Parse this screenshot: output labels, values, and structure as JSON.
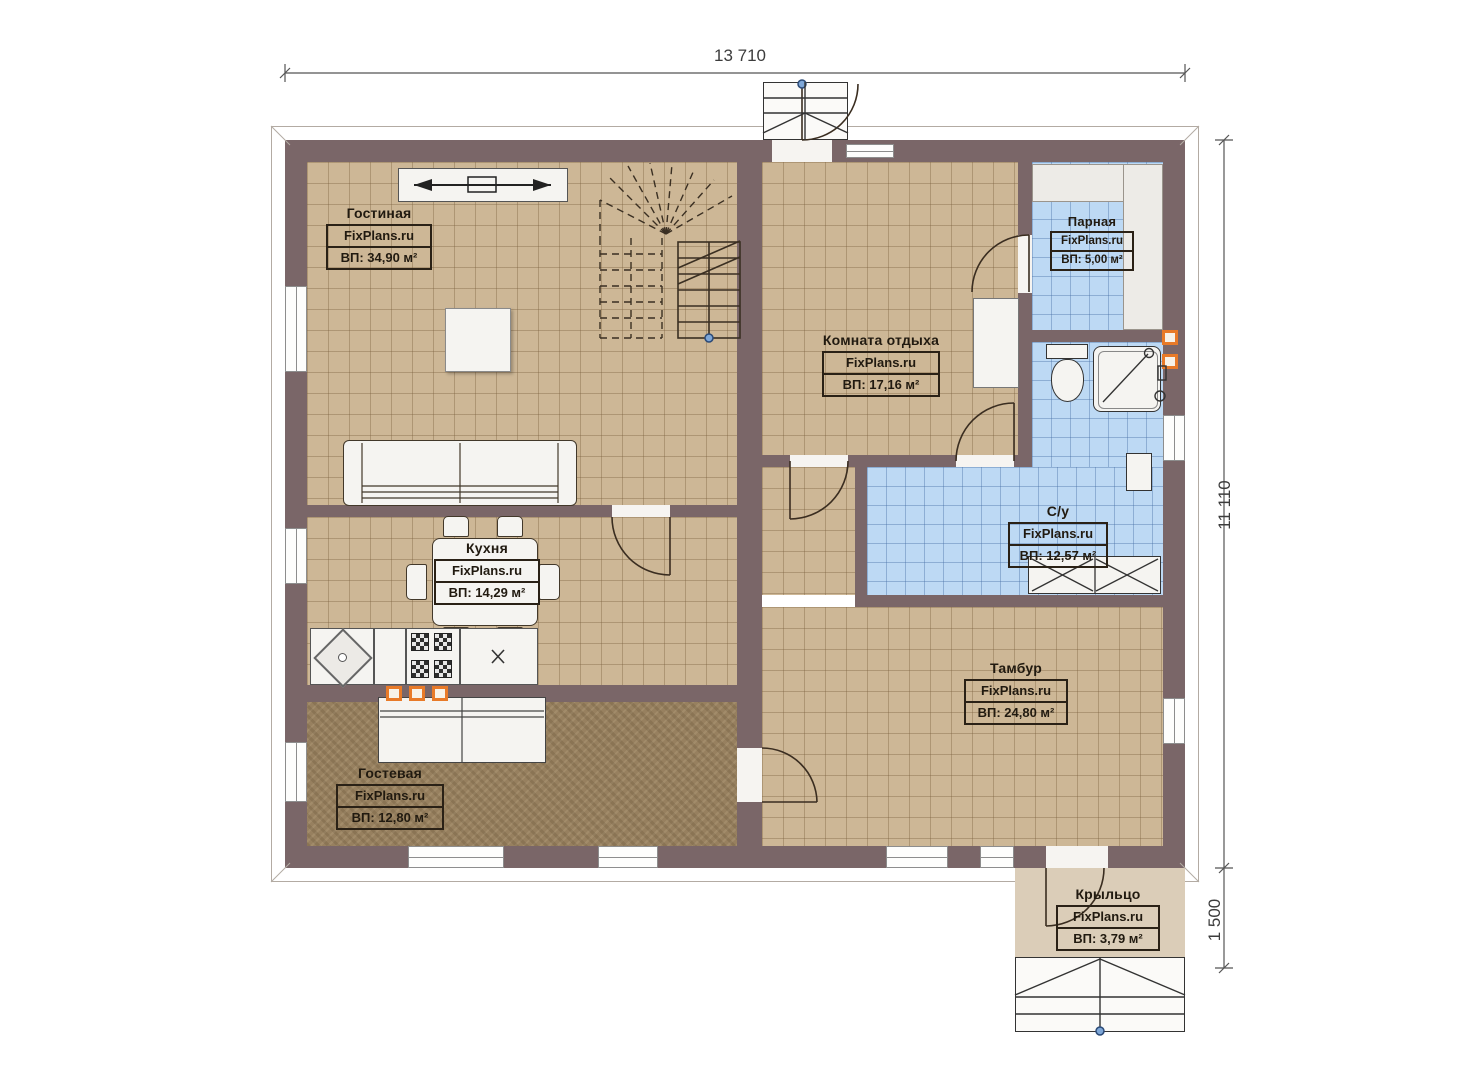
{
  "plan": {
    "brand": "FixPlans.ru",
    "palette": {
      "wall": "#7a6668",
      "floor_tile_tan": "#cdb796",
      "floor_tile_blue": "#bdd9f4",
      "floor_guest_dark": "#97805f",
      "porch_floor": "#dbcdb8",
      "vent_orange": "#e87a28",
      "door_pivot_blue": "#4a6fa5"
    },
    "dimensions": {
      "top_width": "13 710",
      "right_height": "11 110",
      "porch_depth": "1 500"
    },
    "rooms": [
      {
        "id": "living",
        "name": "Гостиная",
        "brand": "FixPlans.ru",
        "area": "ВП: 34,90 м²"
      },
      {
        "id": "kitchen",
        "name": "Кухня",
        "brand": "FixPlans.ru",
        "area": "ВП: 14,29 м²"
      },
      {
        "id": "guest",
        "name": "Гостевая",
        "brand": "FixPlans.ru",
        "area": "ВП: 12,80 м²"
      },
      {
        "id": "rest",
        "name": "Комната отдыха",
        "brand": "FixPlans.ru",
        "area": "ВП: 17,16 м²"
      },
      {
        "id": "steam",
        "name": "Парная",
        "brand": "FixPlans.ru",
        "area": "ВП: 5,00 м²"
      },
      {
        "id": "wc",
        "name": "С/у",
        "brand": "FixPlans.ru",
        "area": "ВП: 12,57 м²"
      },
      {
        "id": "tambour",
        "name": "Тамбур",
        "brand": "FixPlans.ru",
        "area": "ВП: 24,80 м²"
      },
      {
        "id": "porch",
        "name": "Крыльцо",
        "brand": "FixPlans.ru",
        "area": "ВП: 3,79 м²"
      }
    ]
  }
}
